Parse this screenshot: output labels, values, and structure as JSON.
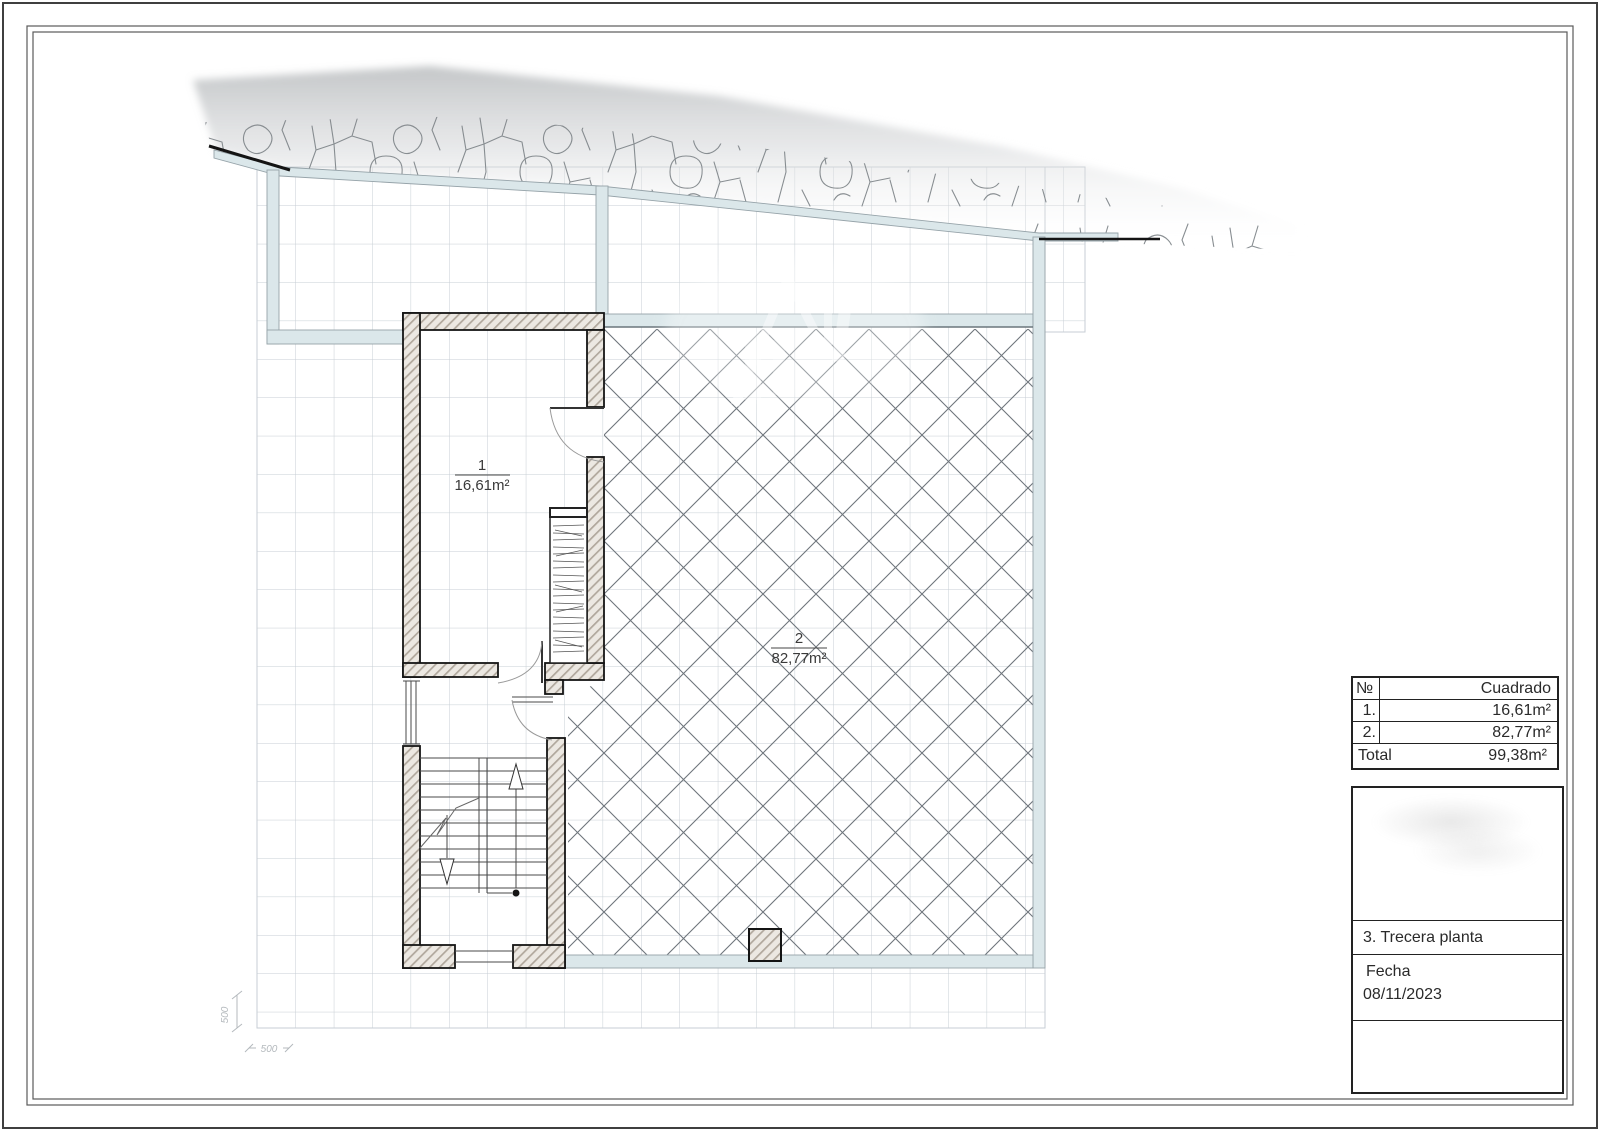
{
  "plan": {
    "room1": {
      "number": "1",
      "area": "16,61m²"
    },
    "room2": {
      "number": "2",
      "area": "82,77m²"
    },
    "dim_vertical": "500",
    "dim_horizontal": "500"
  },
  "area_table": {
    "header_num": "№",
    "header_name": "Cuadrado",
    "rows": [
      {
        "num": "1.",
        "area": "16,61m²"
      },
      {
        "num": "2.",
        "area": "82,77m²"
      }
    ],
    "total_label": "Total",
    "total_value": "99,38m²"
  },
  "title_block": {
    "plan_name": "3. Trecera planta",
    "date_label": "Fecha",
    "date_value": "08/11/2023"
  },
  "colors": {
    "glass_wall_fill": "#dbe7ea",
    "wall_hatch": "#b0a79c",
    "grid_line": "#c7ced4",
    "crosshatch_line": "#6e757c",
    "outline_dark": "#141414"
  }
}
